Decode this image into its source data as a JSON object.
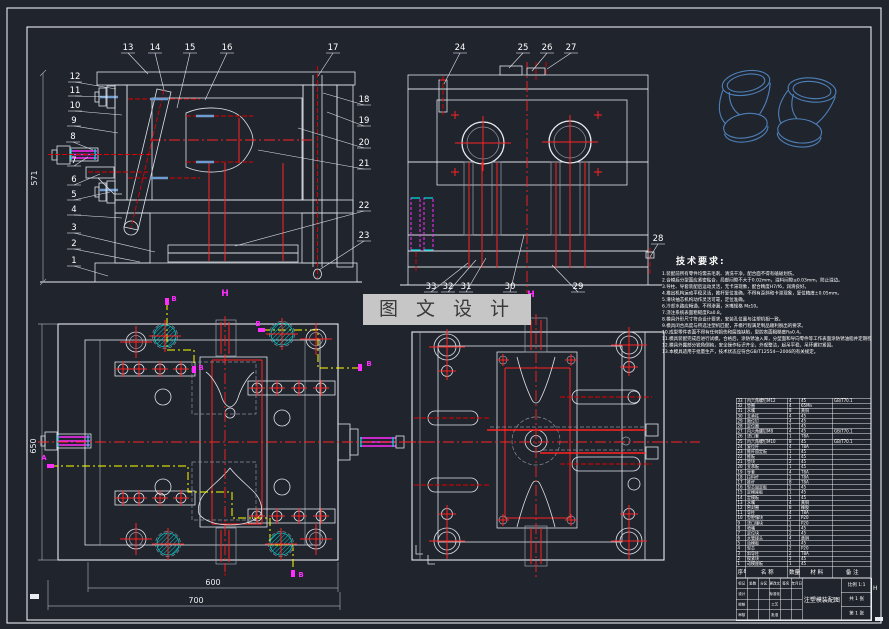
{
  "drawing": {
    "background": "#20242d",
    "accent_colors": {
      "centerline_red": "#ff2222",
      "section_yellow": "#ffff00",
      "magenta": "#ff2dff",
      "cyan": "#00d8d8",
      "wireframe_blue": "#4d80b8",
      "hatch_gray": "#b9bec6",
      "line_white": "#e9ecf0"
    },
    "callouts": [
      {
        "n": "1",
        "x": 74,
        "y": 263,
        "tx": 108,
        "ty": 276
      },
      {
        "n": "2",
        "x": 74,
        "y": 246,
        "tx": 140,
        "ty": 262
      },
      {
        "n": "3",
        "x": 74,
        "y": 230,
        "tx": 155,
        "ty": 252
      },
      {
        "n": "4",
        "x": 74,
        "y": 212,
        "tx": 122,
        "ty": 218
      },
      {
        "n": "5",
        "x": 74,
        "y": 197,
        "tx": 110,
        "ty": 192
      },
      {
        "n": "6",
        "x": 74,
        "y": 182,
        "tx": 100,
        "ty": 174
      },
      {
        "n": "7",
        "x": 74,
        "y": 163,
        "tx": 88,
        "ty": 157
      },
      {
        "n": "8",
        "x": 73,
        "y": 139,
        "tx": 93,
        "ty": 150
      },
      {
        "n": "9",
        "x": 74,
        "y": 123,
        "tx": 118,
        "ty": 133
      },
      {
        "n": "10",
        "x": 75,
        "y": 108,
        "tx": 122,
        "ty": 115
      },
      {
        "n": "11",
        "x": 75,
        "y": 93,
        "tx": 106,
        "ty": 97
      },
      {
        "n": "12",
        "x": 75,
        "y": 79,
        "tx": 116,
        "ty": 89
      },
      {
        "n": "13",
        "x": 128,
        "y": 50,
        "tx": 148,
        "ty": 74
      },
      {
        "n": "14",
        "x": 155,
        "y": 50,
        "tx": 164,
        "ty": 90
      },
      {
        "n": "15",
        "x": 190,
        "y": 50,
        "tx": 177,
        "ty": 108
      },
      {
        "n": "16",
        "x": 227,
        "y": 50,
        "tx": 205,
        "ty": 100
      },
      {
        "n": "17",
        "x": 333,
        "y": 50,
        "tx": 318,
        "ty": 76
      },
      {
        "n": "18",
        "x": 364,
        "y": 102,
        "tx": 323,
        "ty": 93
      },
      {
        "n": "19",
        "x": 364,
        "y": 123,
        "tx": 327,
        "ty": 112
      },
      {
        "n": "20",
        "x": 364,
        "y": 145,
        "tx": 298,
        "ty": 128
      },
      {
        "n": "21",
        "x": 364,
        "y": 166,
        "tx": 258,
        "ty": 150
      },
      {
        "n": "22",
        "x": 364,
        "y": 208,
        "tx": 235,
        "ty": 246
      },
      {
        "n": "23",
        "x": 364,
        "y": 238,
        "tx": 319,
        "ty": 270
      },
      {
        "n": "24",
        "x": 460,
        "y": 50,
        "tx": 444,
        "ty": 84
      },
      {
        "n": "25",
        "x": 523,
        "y": 50,
        "tx": 509,
        "ty": 68
      },
      {
        "n": "26",
        "x": 547,
        "y": 50,
        "tx": 532,
        "ty": 71
      },
      {
        "n": "27",
        "x": 571,
        "y": 50,
        "tx": 547,
        "ty": 69
      },
      {
        "n": "28",
        "x": 658,
        "y": 241,
        "tx": 650,
        "ty": 257
      },
      {
        "n": "29",
        "x": 578,
        "y": 289,
        "tx": 552,
        "ty": 265
      },
      {
        "n": "30",
        "x": 510,
        "y": 289,
        "tx": 524,
        "ty": 235
      },
      {
        "n": "31",
        "x": 466,
        "y": 289,
        "tx": 486,
        "ty": 258
      },
      {
        "n": "32",
        "x": 448,
        "y": 289,
        "tx": 476,
        "ty": 260
      },
      {
        "n": "33",
        "x": 431,
        "y": 289,
        "tx": 468,
        "ty": 263
      }
    ],
    "section_letters": [
      {
        "t": "B",
        "x": 174,
        "y": 301
      },
      {
        "t": "B",
        "x": 201,
        "y": 370
      },
      {
        "t": "A",
        "x": 44,
        "y": 460
      },
      {
        "t": "B",
        "x": 301,
        "y": 577
      },
      {
        "t": "B",
        "x": 258,
        "y": 326
      },
      {
        "t": "B",
        "x": 369,
        "y": 366
      }
    ],
    "h_marks": [
      {
        "t": "H",
        "x": 225,
        "y": 296
      },
      {
        "t": "H",
        "x": 531,
        "y": 297
      }
    ],
    "dims": {
      "front_height": "571",
      "plan_height": "650",
      "plan_inner_width": "600",
      "plan_outer_width": "700"
    },
    "plan_left": {
      "corner_circles": [
        [
          136,
          342
        ],
        [
          316,
          339
        ],
        [
          136,
          539
        ],
        [
          316,
          539
        ]
      ],
      "cyan_circles": [
        [
          165,
          336
        ],
        [
          282,
          334
        ],
        [
          168,
          544
        ],
        [
          281,
          544
        ]
      ],
      "screws": [
        [
          123,
          369
        ],
        [
          139,
          369
        ],
        [
          160,
          369
        ],
        [
          181,
          369
        ],
        [
          123,
          498
        ],
        [
          139,
          498
        ],
        [
          160,
          498
        ],
        [
          181,
          498
        ],
        [
          257,
          388
        ],
        [
          277,
          388
        ],
        [
          299,
          388
        ],
        [
          321,
          388
        ],
        [
          257,
          516
        ],
        [
          277,
          516
        ],
        [
          299,
          516
        ],
        [
          321,
          516
        ]
      ],
      "mid_circles": [
        [
          163,
          397
        ],
        [
          282,
          418
        ],
        [
          163,
          487
        ],
        [
          282,
          487
        ]
      ]
    },
    "plan_right": {
      "corner_circles": [
        [
          447,
          347
        ],
        [
          629,
          345
        ],
        [
          447,
          541
        ],
        [
          629,
          541
        ]
      ],
      "screws": [
        [
          447,
          371
        ],
        [
          629,
          367
        ],
        [
          447,
          514
        ],
        [
          629,
          514
        ]
      ],
      "core_screws": [
        [
          503,
          360
        ],
        [
          571,
          360
        ],
        [
          503,
          520
        ],
        [
          571,
          520
        ]
      ],
      "rail_circles": [
        [
          634,
          397
        ],
        [
          634,
          484
        ]
      ]
    },
    "parts3d": [
      {
        "x": 746,
        "y": 83,
        "r": -10
      },
      {
        "x": 812,
        "y": 90,
        "r": 6
      }
    ]
  },
  "tech": {
    "title": "技术要求:",
    "lines": [
      "1.装配前所有零件均需去毛刺、清洗干净，配合面不得有磕碰划伤。",
      "2.合模后分型面应紧密贴合，局部间隙不大于0.02mm，溢料间隙≤0.03mm，防止溢边。",
      "3.导柱、导套装配后运动灵活，无卡滞现象，配合精度H7/f6，润滑良好。",
      "4.推出机构运动平稳灵活，推杆复位准确，不得有歪斜和卡滞现象，复位精度±0.05mm。",
      "5.滑块抽芯机构动作灵活可靠，定位准确。",
      "6.冷却水路应畅通，不得渗漏，水嘴规格 Mz10。",
      "7.浇注系统表面粗糙度Ra0.8。",
      "8.模具外形尺寸符合设计要求，安装孔位置与注塑机相一致。",
      "9.模具闭合高度与所选注塑机匹配，开模行程满足制品顺利脱出的要求。",
      "10.成型零件表面不得有任何损伤和腐蚀缺陷，型腔表面粗糙度Ra0.4。",
      "11.模具装配完成后进行试模，合格后，涂防锈油入库，分型面和导向零件等工作表面涂防锈油脂并定期检查。",
      "12.模具外露部分锐角倒钝，安全操作标识齐全，外观整洁，起吊平稳，吊环螺钉紧固。",
      "13.本模具适用于批量生产，技术状态应符合GB/T12554—2006的有关规定。"
    ]
  },
  "bom": {
    "headers": [
      "序号",
      "名  称",
      "数量",
      "材 料",
      "备 注"
    ],
    "rows": [
      [
        "33",
        "内六角螺钉M12",
        "4",
        "45",
        "GB/T70.1"
      ],
      [
        "32",
        "垫圈",
        "4",
        "65Mn",
        ""
      ],
      [
        "31",
        "水嘴",
        "8",
        "黄铜",
        ""
      ],
      [
        "30",
        "支承柱",
        "4",
        "45",
        ""
      ],
      [
        "29",
        "限位钉",
        "4",
        "45",
        ""
      ],
      [
        "28",
        "定位圈",
        "1",
        "45",
        ""
      ],
      [
        "27",
        "内六角螺钉M8",
        "4",
        "45",
        "GB/T70.1"
      ],
      [
        "26",
        "浇口套",
        "1",
        "T8A",
        ""
      ],
      [
        "25",
        "内六角螺钉M10",
        "8",
        "45",
        "GB/T70.1"
      ],
      [
        "24",
        "复位杆",
        "4",
        "T8A",
        ""
      ],
      [
        "23",
        "推杆固定板",
        "1",
        "45",
        ""
      ],
      [
        "22",
        "推板",
        "1",
        "45",
        ""
      ],
      [
        "21",
        "垫块",
        "2",
        "45",
        ""
      ],
      [
        "20",
        "支承板",
        "1",
        "45",
        ""
      ],
      [
        "19",
        "导套",
        "4",
        "T8A",
        ""
      ],
      [
        "18",
        "拉料杆",
        "1",
        "T8A",
        ""
      ],
      [
        "17",
        "推杆",
        "8",
        "T8A",
        ""
      ],
      [
        "16",
        "型芯固定板",
        "1",
        "45",
        ""
      ],
      [
        "15",
        "定模座板",
        "1",
        "45",
        ""
      ],
      [
        "14",
        "定模板",
        "1",
        "45",
        ""
      ],
      [
        "13",
        "水嘴",
        "4",
        "黄铜",
        ""
      ],
      [
        "12",
        "密封圈",
        "8",
        "橡胶",
        ""
      ],
      [
        "11",
        "导柱",
        "4",
        "T8A",
        ""
      ],
      [
        "10",
        "型腔镶块",
        "2",
        "P20",
        ""
      ],
      [
        "9",
        "浇口镶块",
        "1",
        "P20",
        ""
      ],
      [
        "8",
        "喷嘴",
        "1",
        "45",
        ""
      ],
      [
        "7",
        "定位块",
        "2",
        "45",
        ""
      ],
      [
        "6",
        "水管接头",
        "4",
        "黄铜",
        ""
      ],
      [
        "5",
        "动模板",
        "1",
        "45",
        ""
      ],
      [
        "4",
        "型芯",
        "2",
        "P20",
        ""
      ],
      [
        "3",
        "斜导柱",
        "2",
        "T8A",
        ""
      ],
      [
        "2",
        "楔紧块",
        "2",
        "45",
        ""
      ],
      [
        "1",
        "动模座板",
        "1",
        "45",
        ""
      ]
    ]
  },
  "title_block": {
    "left_grid": [
      [
        "标记",
        "处数",
        "分区",
        "更改文件号",
        "签名",
        "年月日"
      ],
      [
        "设计",
        "",
        "",
        "标准化",
        "",
        ""
      ],
      [
        "校核",
        "",
        "",
        "工艺",
        "",
        ""
      ],
      [
        "审核",
        "",
        "",
        "批准",
        "",
        ""
      ]
    ],
    "title": "注塑模装配图",
    "scale": "比例 1:1",
    "sheets": "共 1 张",
    "sheet_no": "第 1 张"
  },
  "watermark": {
    "text": "图 文 设 计"
  },
  "fold_marks": {
    "right": "H"
  }
}
